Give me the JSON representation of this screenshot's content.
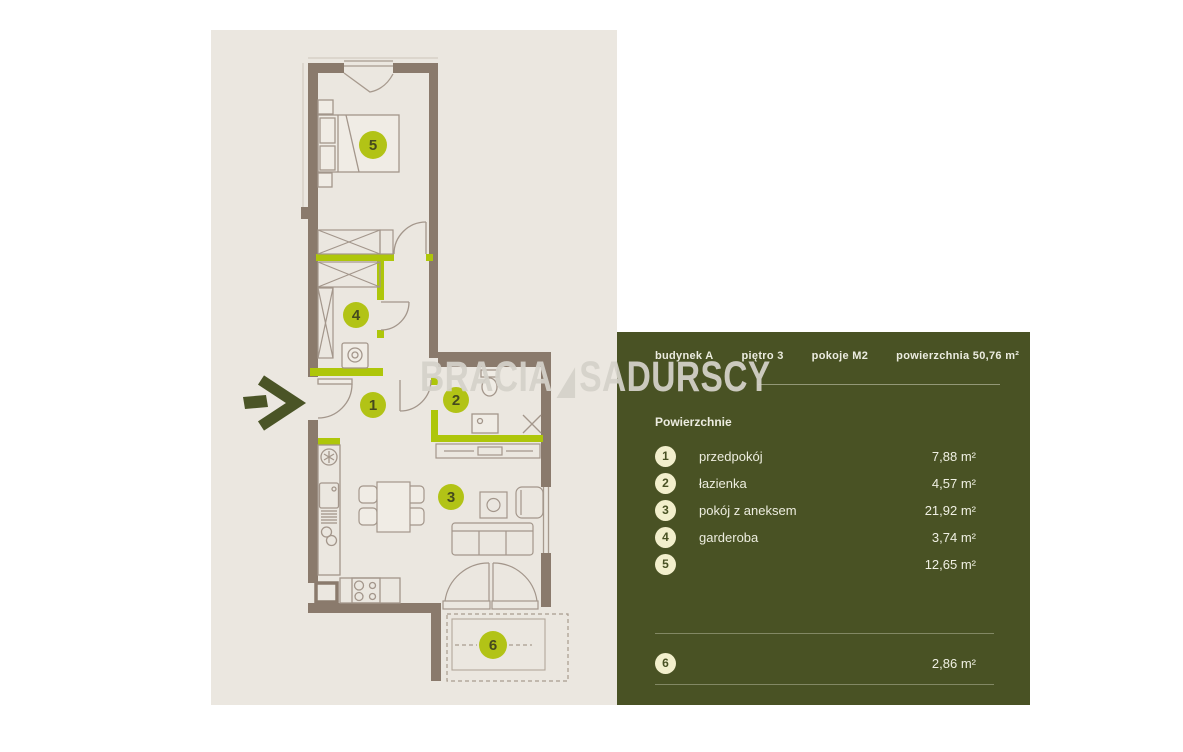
{
  "logo": {
    "left": "BRACIA",
    "right": "SADURSCY"
  },
  "floor_plan": {
    "markers": [
      "1",
      "2",
      "3",
      "4",
      "5",
      "6"
    ]
  },
  "panel": {
    "header": [
      "budynek A",
      "piętro 3",
      "pokoje M2",
      "powierzchnia 50,76 m²"
    ],
    "section_title": "Powierzchnie",
    "rooms": [
      {
        "number": "1",
        "name": "przedpokój",
        "area": "7,88 m²"
      },
      {
        "number": "2",
        "name": "łazienka",
        "area": "4,57 m²"
      },
      {
        "number": "3",
        "name": "pokój z aneksem",
        "area": "21,92 m²"
      },
      {
        "number": "4",
        "name": "garderoba",
        "area": "3,74 m²"
      },
      {
        "number": "5",
        "name": "",
        "area": "12,65 m²"
      },
      {
        "number": "6",
        "name": "",
        "area": "2,86 m²"
      }
    ]
  },
  "colors": {
    "panel_background": "#495224",
    "plan_background": "#ebe7e0",
    "wall": "#8a7a6c",
    "accent_wall": "#aec60a",
    "plan_marker": "#b2c316",
    "legend_circle": "#f2efcc",
    "logo": "#d5d2ca"
  }
}
